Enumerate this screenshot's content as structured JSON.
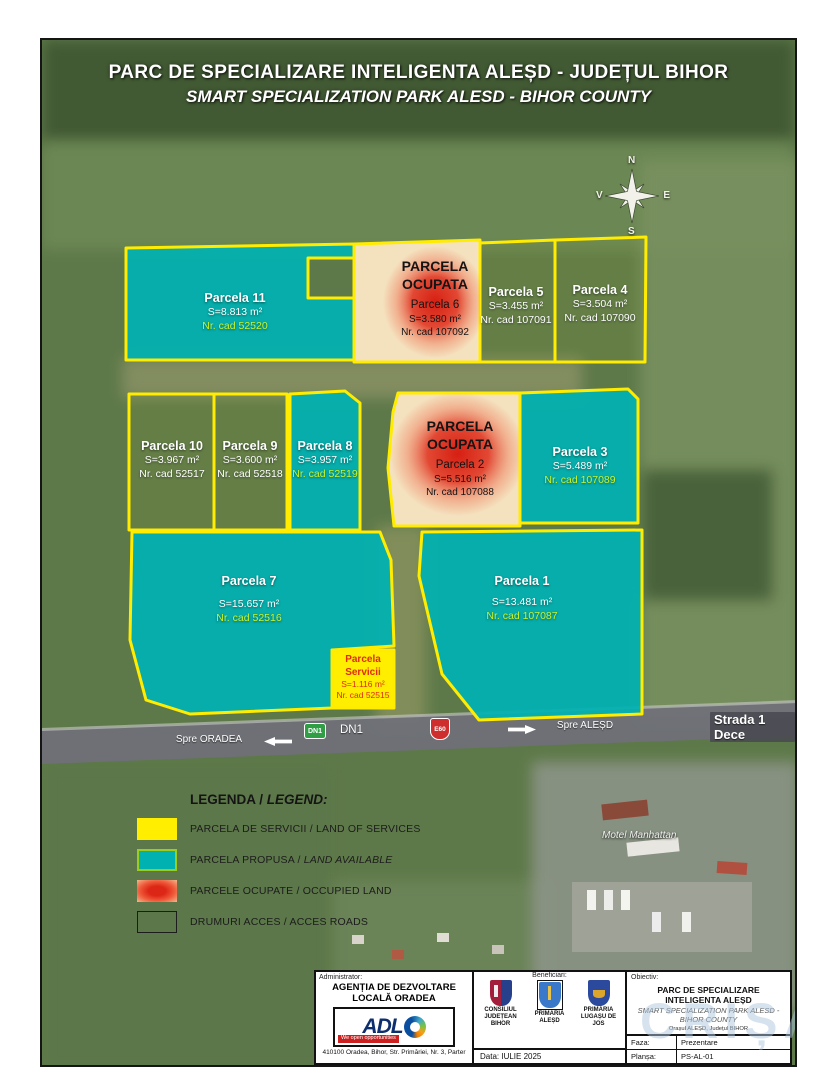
{
  "title": {
    "line1": "PARC DE SPECIALIZARE INTELIGENTA ALEȘD - JUDEȚUL BIHOR",
    "line2": "SMART SPECIALIZATION PARK ALESD - BIHOR COUNTY"
  },
  "compass": {
    "north": "N",
    "east": "E",
    "south": "S",
    "west": "V"
  },
  "parcels": {
    "p11": {
      "name": "Parcela 11",
      "area": "S=8.813 m²",
      "cad": "Nr. cad 52520"
    },
    "p6": {
      "status": "PARCELA OCUPATA",
      "name": "Parcela 6",
      "area": "S=3.580 m²",
      "cad": "Nr. cad 107092"
    },
    "p5": {
      "name": "Parcela 5",
      "area": "S=3.455 m²",
      "cad": "Nr. cad 107091"
    },
    "p4": {
      "name": "Parcela 4",
      "area": "S=3.504 m²",
      "cad": "Nr. cad 107090"
    },
    "p10": {
      "name": "Parcela 10",
      "area": "S=3.967 m²",
      "cad": "Nr. cad 52517"
    },
    "p9": {
      "name": "Parcela 9",
      "area": "S=3.600 m²",
      "cad": "Nr. cad 52518"
    },
    "p8": {
      "name": "Parcela 8",
      "area": "S=3.957 m²",
      "cad": "Nr. cad 52519"
    },
    "p2": {
      "status": "PARCELA OCUPATA",
      "name": "Parcela 2",
      "area": "S=5.516 m²",
      "cad": "Nr. cad 107088"
    },
    "p3": {
      "name": "Parcela 3",
      "area": "S=5.489 m²",
      "cad": "Nr. cad 107089"
    },
    "p7": {
      "name": "Parcela 7",
      "area": "S=15.657 m²",
      "cad": "Nr. cad 52516"
    },
    "p1": {
      "name": "Parcela 1",
      "area": "S=13.481 m²",
      "cad": "Nr. cad 107087"
    },
    "servicii": {
      "name1": "Parcela",
      "name2": "Servicii",
      "area": "S=1.116 m²",
      "cad": "Nr. cad 52515"
    }
  },
  "road": {
    "to_oradea": "Spre ORADEA",
    "dn1_shield": "DN1",
    "dn1_text": "DN1",
    "e60_shield": "E60",
    "to_alesd": "Spre ALEȘD",
    "street": "Strada 1 Dece"
  },
  "map_labels": {
    "motel": "Motel Manhattan"
  },
  "legend": {
    "title_ro": "LEGENDA /",
    "title_en": "LEGEND:",
    "items": [
      {
        "ro": "PARCELA DE SERVICII /",
        "en": "LAND OF SERVICES"
      },
      {
        "ro": "PARCELA PROPUSA /",
        "en": "LAND AVAILABLE"
      },
      {
        "ro": "PARCELE OCUPATE /",
        "en": "OCCUPIED LAND"
      },
      {
        "ro": "DRUMURI ACCES /",
        "en": "ACCES ROADS"
      }
    ]
  },
  "panel": {
    "administrator": {
      "label": "Administrator:",
      "name": "AGENȚIA DE DEZVOLTARE LOCALĂ ORADEA",
      "logo": "ADL",
      "tagline": "We open opportunities",
      "address": "410100 Oradea, Bihor, Str. Primăriei, Nr. 3, Parter"
    },
    "beneficiaries": {
      "label": "Beneficiari:",
      "items": [
        "CONSILIUL JUDEȚEAN BIHOR",
        "PRIMĂRIA ALEȘD",
        "PRIMĂRIA LUGAȘU DE JOS"
      ],
      "date": "Data: IULIE 2025"
    },
    "objective": {
      "label": "Obiectiv:",
      "title": "PARC DE SPECIALIZARE INTELIGENTA ALEȘD",
      "subtitle": "SMART SPECIALIZATION PARK ALESD - BIHOR COUNTY",
      "location": "Orașul ALEȘD, Județul BIHOR",
      "faza_label": "Faza:",
      "faza_value": "Prezentare",
      "plansa_label": "Planșa:",
      "plansa_value": "PS-AL-01"
    }
  },
  "watermark": "CRIȘANA",
  "colors": {
    "land_available": "#00b1b1",
    "land_services": "#ffee00",
    "land_occupied": "#dc2616",
    "parcel_border": "#ffec00",
    "cad_highlight": "#c6f42f"
  }
}
